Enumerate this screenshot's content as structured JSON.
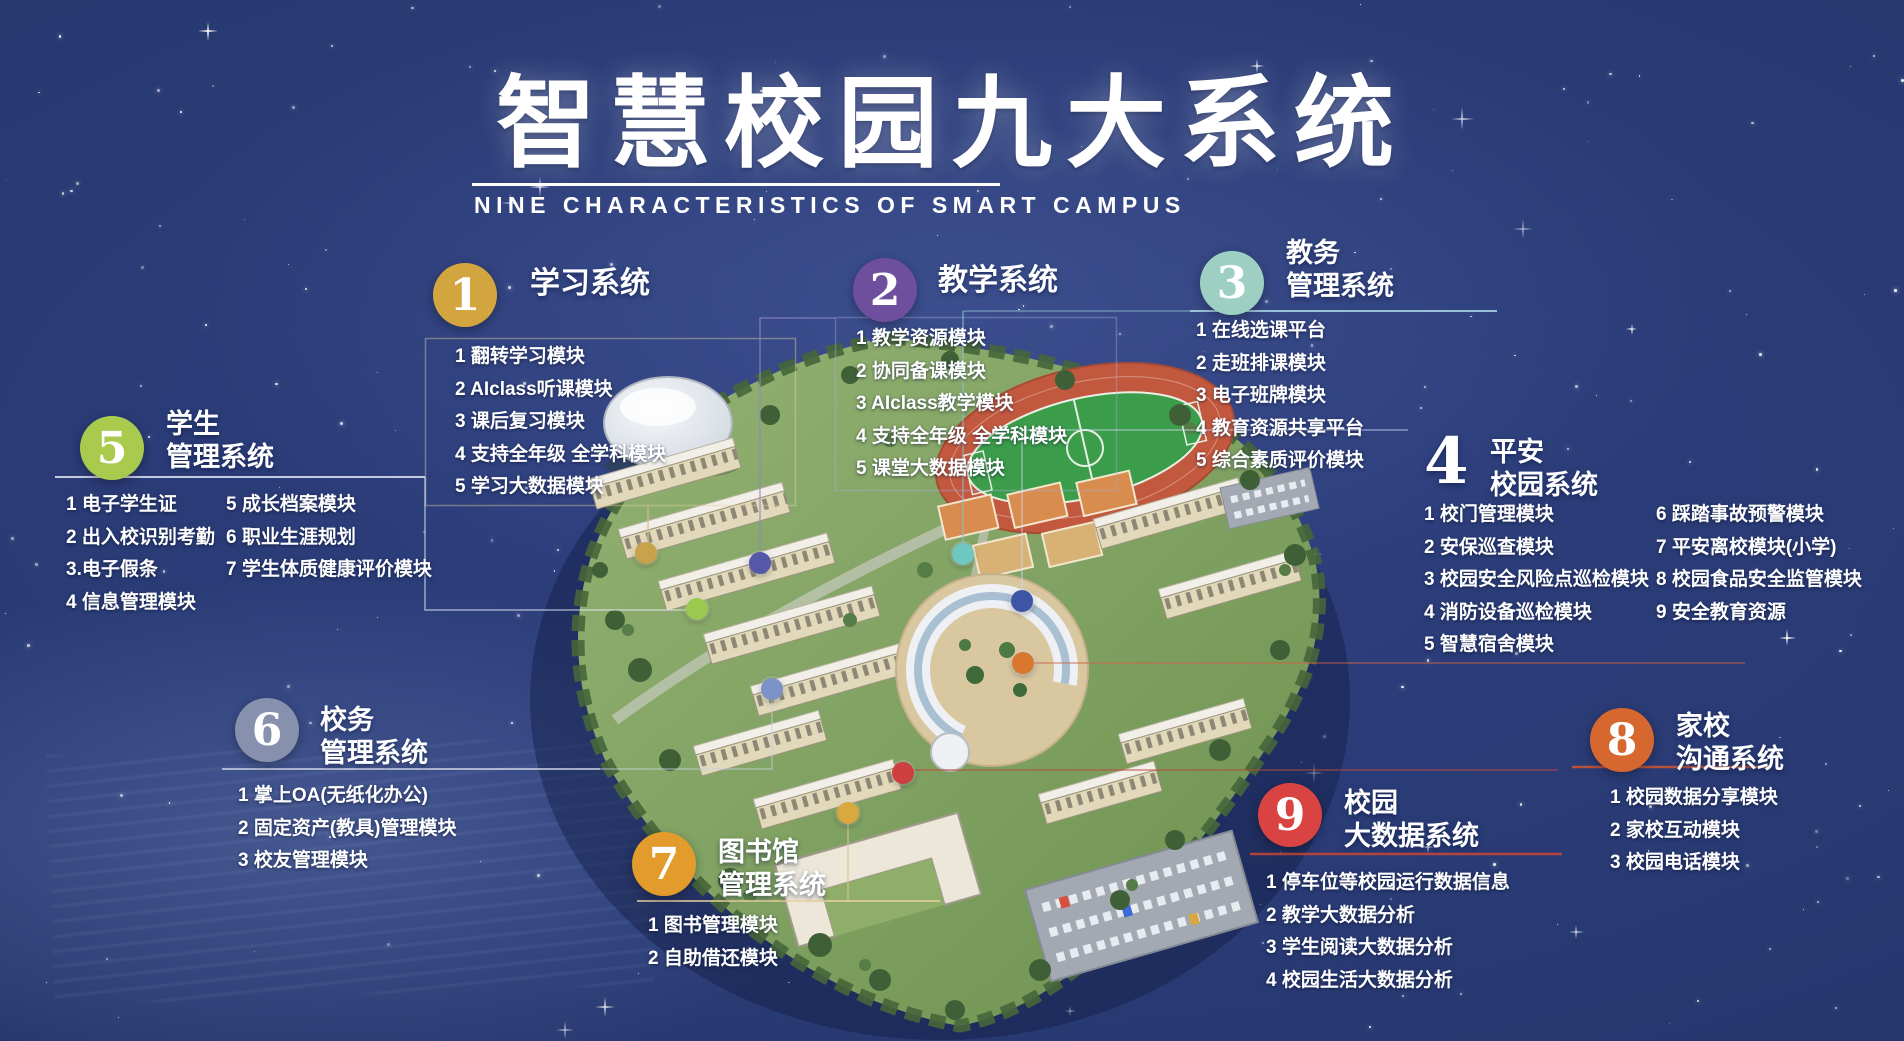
{
  "header": {
    "title": "智慧校园九大系统",
    "subtitle": "NINE CHARACTERISTICS OF SMART CAMPUS"
  },
  "systems": [
    {
      "num": "1",
      "name_lines": [
        "学习系统"
      ],
      "accent": "#d2a53e",
      "dot": "#c9a34c",
      "items": [
        "1 翻转学习模块",
        "2 AIclass听课模块",
        "3 课后复习模块",
        "4 支持全年级 全学科模块",
        "5 学习大数据模块"
      ]
    },
    {
      "num": "2",
      "name_lines": [
        "教学系统"
      ],
      "accent": "#6e4f9e",
      "dot": "#5558a8",
      "items": [
        "1 教学资源模块",
        "2 协同备课模块",
        "3 AIclass教学模块",
        "4 支持全年级 全学科模块",
        "5 课堂大数据模块"
      ]
    },
    {
      "num": "3",
      "name_lines": [
        "教务",
        "管理系统"
      ],
      "accent": "#9dd0c3",
      "dot": "#6fc8c0",
      "items": [
        "1 在线选课平台",
        "2 走班排课模块",
        "3 电子班牌模块",
        "4 教育资源共享平台",
        "5 综合素质评价模块"
      ]
    },
    {
      "num": "4",
      "name_lines": [
        "平安",
        "校园系统"
      ],
      "accent": "#ffffff",
      "dot": "#3d55a5",
      "items_left": [
        "1 校门管理模块",
        "2 安保巡查模块",
        "3 校园安全风险点巡检模块",
        "4 消防设备巡检模块",
        "5 智慧宿舍模块"
      ],
      "items_right": [
        "6 踩踏事故预警模块",
        "7 平安离校模块(小学)",
        "8 校园食品安全监管模块",
        "9 安全教育资源"
      ]
    },
    {
      "num": "5",
      "name_lines": [
        "学生",
        "管理系统"
      ],
      "accent": "#a9ca4d",
      "dot": "#9bc84e",
      "items_left": [
        "1 电子学生证",
        "2 出入校识别考勤",
        "3.电子假条",
        "4 信息管理模块"
      ],
      "items_right": [
        "5 成长档案模块",
        "6 职业生涯规划",
        "7 学生体质健康评价模块"
      ]
    },
    {
      "num": "6",
      "name_lines": [
        "校务",
        "管理系统"
      ],
      "accent": "#8791ad",
      "dot": "#7c93c8",
      "items": [
        "1 掌上OA(无纸化办公)",
        "2 固定资产(教具)管理模块",
        "3 校友管理模块"
      ]
    },
    {
      "num": "7",
      "name_lines": [
        "图书馆",
        "管理系统"
      ],
      "accent": "#e39b2c",
      "dot": "#d9a93f",
      "items": [
        "1 图书管理模块",
        "2 自助借还模块"
      ]
    },
    {
      "num": "8",
      "name_lines": [
        "家校",
        "沟通系统"
      ],
      "accent": "#d5672f",
      "dot": "#d9772e",
      "items": [
        "1 校园数据分享模块",
        "2 家校互动模块",
        "3 校园电话模块"
      ]
    },
    {
      "num": "9",
      "name_lines": [
        "校园",
        "大数据系统"
      ],
      "accent": "#d94442",
      "dot": "#ce4040",
      "items": [
        "1 停车位等校园运行数据信息",
        "2 教学大数据分析",
        "3 学生阅读大数据分析",
        "4 校园生活大数据分析"
      ]
    }
  ]
}
